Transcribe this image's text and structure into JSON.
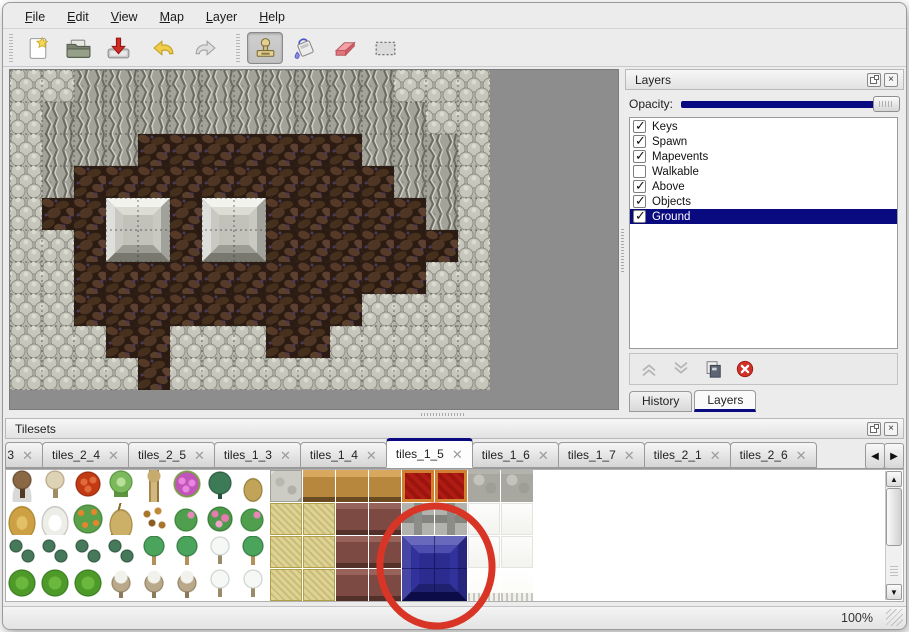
{
  "menu": {
    "items": [
      {
        "label": "File"
      },
      {
        "label": "Edit"
      },
      {
        "label": "View"
      },
      {
        "label": "Map"
      },
      {
        "label": "Layer"
      },
      {
        "label": "Help"
      }
    ]
  },
  "toolbar": {
    "buttons": [
      {
        "name": "new-file",
        "icon": "new",
        "active": false
      },
      {
        "name": "open-file",
        "icon": "open",
        "active": false
      },
      {
        "name": "save-file",
        "icon": "save",
        "active": false
      },
      {
        "name": "undo",
        "icon": "undo",
        "active": false
      },
      {
        "name": "redo",
        "icon": "redo",
        "active": false
      },
      {
        "name": "stamp-tool",
        "icon": "stamp",
        "active": true
      },
      {
        "name": "fill-tool",
        "icon": "fill",
        "active": false
      },
      {
        "name": "eraser-tool",
        "icon": "eraser",
        "active": false
      },
      {
        "name": "select-tool",
        "icon": "select",
        "active": false
      }
    ]
  },
  "map": {
    "tile_size": 32,
    "legend": {
      "S": "light-stone-shingle",
      "C": "cliff-rock",
      "G": "brown-ground"
    },
    "grid": [
      "SSCCCCCCCCCCSSS",
      "SCCCCCCCCCCCCSS",
      "SCCCGGGGGGGCCCS",
      "SCGGGGGGGGGGCCS",
      "SGGGGGGGGGGGGCS",
      "SSGGGGGGGGGGGGS",
      "SSGGGGGGGGGGGSS",
      "SSGGGGGGGGGSSSS",
      "SSSGGSSSGGSSSSS",
      "SSSSGSSSSSSSSSS"
    ],
    "blocks": [
      {
        "col": 3,
        "row": 4
      },
      {
        "col": 6,
        "row": 4
      }
    ]
  },
  "layers_panel": {
    "title": "Layers",
    "opacity_label": "Opacity:",
    "opacity_percent": 100,
    "layers": [
      {
        "name": "Keys",
        "visible": true,
        "selected": false
      },
      {
        "name": "Spawn",
        "visible": true,
        "selected": false
      },
      {
        "name": "Mapevents",
        "visible": true,
        "selected": false
      },
      {
        "name": "Walkable",
        "visible": false,
        "selected": false
      },
      {
        "name": "Above",
        "visible": true,
        "selected": false
      },
      {
        "name": "Objects",
        "visible": true,
        "selected": false
      },
      {
        "name": "Ground",
        "visible": true,
        "selected": true
      }
    ],
    "buttons": [
      {
        "name": "move-layer-up",
        "icon": "chevUp",
        "disabled": true
      },
      {
        "name": "move-layer-down",
        "icon": "chevDown",
        "disabled": true
      },
      {
        "name": "duplicate-layer",
        "icon": "dup",
        "disabled": false
      },
      {
        "name": "delete-layer",
        "icon": "del",
        "disabled": false
      }
    ]
  },
  "dock_tabs": [
    {
      "label": "History",
      "active": false
    },
    {
      "label": "Layers",
      "active": true
    }
  ],
  "tilesets_panel": {
    "title": "Tilesets",
    "tabs": [
      {
        "label": "3",
        "partial": true,
        "active": false
      },
      {
        "label": "tiles_2_4",
        "active": false
      },
      {
        "label": "tiles_2_5",
        "active": false
      },
      {
        "label": "tiles_1_3",
        "active": false
      },
      {
        "label": "tiles_1_4",
        "active": false
      },
      {
        "label": "tiles_1_5",
        "active": true
      },
      {
        "label": "tiles_1_6",
        "active": false
      },
      {
        "label": "tiles_1_7",
        "active": false
      },
      {
        "label": "tiles_2_1",
        "active": false
      },
      {
        "label": "tiles_2_6",
        "active": false
      }
    ],
    "palette_rows": [
      [
        "treeBrown",
        "treeDead",
        "flowerRed",
        "stump",
        "trunk",
        "flowerPink",
        "plantDark",
        "plantDry",
        "stoneTile",
        "tableTan",
        "tableTan",
        "tableTan",
        "carpetRed",
        "carpetRed",
        "stoneGray",
        "stoneGray"
      ],
      [
        "hay",
        "snowMound",
        "flowerPatch",
        "grassDry",
        "leaves",
        "lilyPad",
        "roseBush",
        "lilyPad",
        "matTan",
        "matTan",
        "tableBrown",
        "tableBrown",
        "beamGray",
        "beamGray",
        "tileWhite",
        "tileWhite"
      ],
      [
        "bushSmall",
        "bushSmall",
        "bushSmall",
        "bushSmall",
        "palm",
        "palm",
        "snowTree",
        "palm",
        "matTan",
        "matTan",
        "tableBrown",
        "tableBrown",
        "blue",
        "blue",
        "tileWhite",
        "tileWhite"
      ],
      [
        "bushGreen",
        "bushGreen",
        "bushGreen",
        "deadSnow",
        "deadSnow",
        "deadSnow",
        "snowTree",
        "snowTree",
        "matTan",
        "matTan",
        "tableBrown",
        "tableBrown",
        "blue",
        "blue",
        "tileWhiteF",
        "tileWhiteF"
      ]
    ],
    "selected_tile": {
      "kind": "blue-tile",
      "col": 12,
      "row": 2,
      "span": 2
    }
  },
  "status_bar": {
    "zoom_level": "100%"
  },
  "colors": {
    "accent_navy": "#0a0a80",
    "selection_bg": "#0a0a80",
    "annotation_red": "#d93526",
    "map_background_gray": "#8d8d8d"
  }
}
